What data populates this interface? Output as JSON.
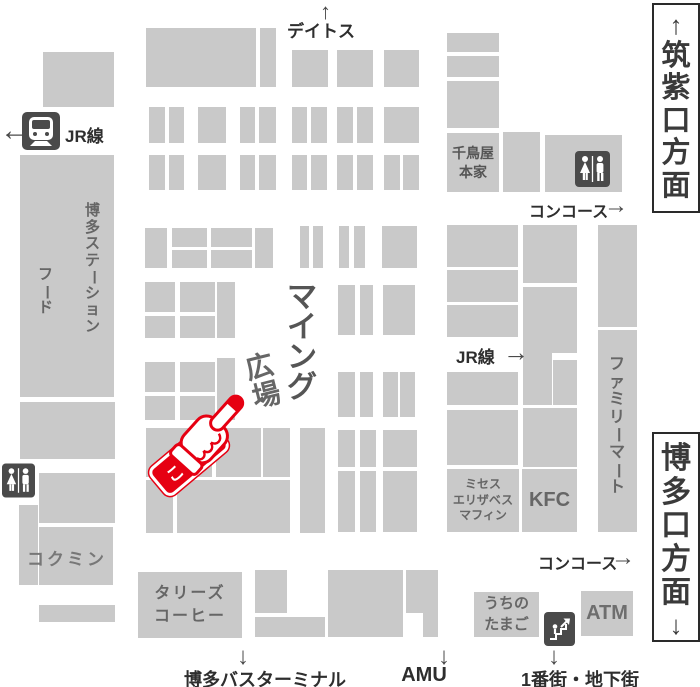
{
  "palette": {
    "block_gray": "#c9c9c9",
    "icon_dark": "#4a4a4a",
    "label_dark": "#2e2e2e",
    "label_gray": "#666666",
    "accent_red": "#e60012"
  },
  "exits": {
    "top": "筑紫口方面",
    "bottom": "博多口方面"
  },
  "directions": {
    "deitos": "デイトス",
    "concourse_upper": "コンコース",
    "concourse_lower": "コンコース",
    "jr_line_left": "JR線",
    "jr_line_right": "JR線",
    "bus_terminal": "博多バスターミナル",
    "amu": "AMU",
    "underground": "1番街・地下街"
  },
  "plaza": {
    "name": "マイング",
    "subname": "広場",
    "pointer": "こちら"
  },
  "shops": {
    "station_food_line1": "博多ステーション",
    "station_food_line2": "フード",
    "chidoriya": "千鳥屋\n本家",
    "kokumin": "コクミン",
    "familymart": "ファミリーマート",
    "mrs_elizabeth_muffin": "ミセス\nエリザベス\nマフィン",
    "kfc": "KFC",
    "tullys": "タリーズ\nコーヒー",
    "uchino_tamago": "うちの\nたまご",
    "atm": "ATM"
  },
  "arrows": {
    "up": "↑",
    "down": "↓",
    "left": "←",
    "right": "→"
  },
  "blocks": [
    [
      43,
      52,
      71,
      55
    ],
    [
      146,
      28,
      110,
      59
    ],
    [
      260,
      28,
      16,
      59
    ],
    [
      292,
      50,
      36,
      37
    ],
    [
      337,
      50,
      36,
      37
    ],
    [
      384,
      50,
      35,
      37
    ],
    [
      447,
      33,
      52,
      19
    ],
    [
      447,
      56,
      52,
      21
    ],
    [
      447,
      81,
      52,
      47
    ],
    [
      503,
      132,
      37,
      60
    ],
    [
      545,
      135,
      77,
      57
    ],
    [
      149,
      107,
      16,
      36
    ],
    [
      169,
      107,
      15,
      36
    ],
    [
      198,
      107,
      28,
      36
    ],
    [
      240,
      107,
      15,
      36
    ],
    [
      259,
      107,
      17,
      36
    ],
    [
      292,
      107,
      15,
      36
    ],
    [
      311,
      107,
      16,
      36
    ],
    [
      337,
      107,
      16,
      36
    ],
    [
      357,
      107,
      16,
      36
    ],
    [
      384,
      107,
      35,
      36
    ],
    [
      149,
      155,
      16,
      35
    ],
    [
      169,
      155,
      15,
      35
    ],
    [
      198,
      155,
      28,
      35
    ],
    [
      240,
      155,
      15,
      35
    ],
    [
      259,
      155,
      17,
      35
    ],
    [
      292,
      155,
      15,
      35
    ],
    [
      311,
      155,
      16,
      35
    ],
    [
      337,
      155,
      16,
      35
    ],
    [
      357,
      155,
      16,
      35
    ],
    [
      384,
      155,
      16,
      35
    ],
    [
      403,
      155,
      16,
      35
    ],
    [
      145,
      228,
      22,
      40
    ],
    [
      172,
      228,
      35,
      19
    ],
    [
      172,
      250,
      35,
      18
    ],
    [
      211,
      228,
      41,
      19
    ],
    [
      211,
      250,
      41,
      18
    ],
    [
      255,
      228,
      18,
      40
    ],
    [
      300,
      226,
      9,
      42
    ],
    [
      313,
      226,
      10,
      42
    ],
    [
      339,
      226,
      10,
      42
    ],
    [
      354,
      226,
      11,
      42
    ],
    [
      382,
      226,
      35,
      42
    ],
    [
      447,
      225,
      71,
      42
    ],
    [
      523,
      225,
      54,
      58
    ],
    [
      598,
      225,
      39,
      102
    ],
    [
      145,
      282,
      30,
      30
    ],
    [
      145,
      316,
      30,
      22
    ],
    [
      180,
      282,
      35,
      30
    ],
    [
      180,
      316,
      35,
      22
    ],
    [
      217,
      282,
      18,
      56
    ],
    [
      145,
      362,
      30,
      30
    ],
    [
      145,
      396,
      30,
      24
    ],
    [
      180,
      362,
      35,
      30
    ],
    [
      180,
      396,
      35,
      24
    ],
    [
      217,
      358,
      18,
      62
    ],
    [
      338,
      285,
      17,
      50
    ],
    [
      360,
      285,
      13,
      50
    ],
    [
      383,
      285,
      32,
      50
    ],
    [
      338,
      372,
      17,
      45
    ],
    [
      360,
      372,
      13,
      45
    ],
    [
      383,
      372,
      15,
      45
    ],
    [
      400,
      372,
      15,
      45
    ],
    [
      447,
      270,
      71,
      32
    ],
    [
      447,
      305,
      71,
      32
    ],
    [
      447,
      372,
      71,
      33
    ],
    [
      447,
      410,
      71,
      55
    ],
    [
      523,
      287,
      54,
      35
    ],
    [
      523,
      322,
      54,
      31
    ],
    [
      523,
      353,
      29,
      52
    ],
    [
      553,
      360,
      24,
      45
    ],
    [
      523,
      408,
      54,
      59
    ],
    [
      20,
      402,
      95,
      57
    ],
    [
      39,
      473,
      76,
      50
    ],
    [
      19,
      505,
      19,
      80
    ],
    [
      39,
      527,
      74,
      58
    ],
    [
      39,
      605,
      76,
      17
    ],
    [
      146,
      428,
      66,
      49
    ],
    [
      216,
      428,
      45,
      49
    ],
    [
      263,
      428,
      27,
      49
    ],
    [
      300,
      428,
      25,
      105
    ],
    [
      338,
      430,
      17,
      37
    ],
    [
      360,
      430,
      16,
      37
    ],
    [
      383,
      430,
      34,
      37
    ],
    [
      146,
      480,
      27,
      53
    ],
    [
      177,
      480,
      113,
      53
    ],
    [
      338,
      471,
      17,
      61
    ],
    [
      360,
      471,
      16,
      61
    ],
    [
      383,
      471,
      34,
      61
    ],
    [
      255,
      570,
      32,
      43
    ],
    [
      255,
      617,
      70,
      20
    ],
    [
      328,
      570,
      75,
      67
    ],
    [
      406,
      570,
      32,
      43
    ],
    [
      423,
      613,
      15,
      24
    ]
  ]
}
